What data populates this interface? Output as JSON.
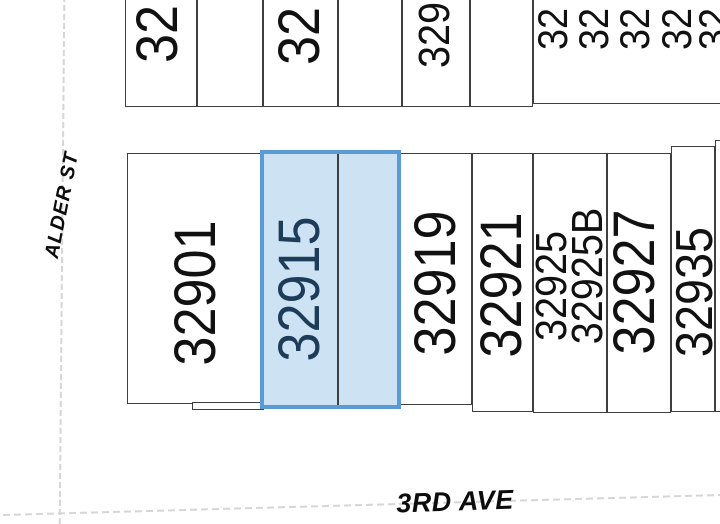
{
  "map": {
    "streets": {
      "alder_st": "ALDER ST",
      "third_ave": "3RD AVE"
    },
    "top_row_lots": [
      {
        "label": "32"
      },
      {
        "label": ""
      },
      {
        "label": "32"
      },
      {
        "label": ""
      },
      {
        "label": "329"
      },
      {
        "label": ""
      }
    ],
    "top_right_lot_labels": [
      "32",
      "32",
      "32",
      "32",
      "32"
    ],
    "bottom_row_lots": [
      {
        "label": "32901",
        "highlighted": false
      },
      {
        "label": "32915",
        "highlighted": true
      },
      {
        "label": "",
        "highlighted": true
      },
      {
        "label": "32919",
        "highlighted": false
      },
      {
        "label": "32921",
        "highlighted": false
      },
      {
        "label": "32925",
        "label2": "32925B",
        "highlighted": false
      },
      {
        "label": "32927",
        "highlighted": false
      },
      {
        "label": "32935",
        "highlighted": false
      }
    ],
    "colors": {
      "highlight_fill": "#cde3f3",
      "highlight_border": "#5b9bd5",
      "highlight_text": "#1d3c5a",
      "lot_line": "#3f3f3f",
      "street_line": "#d6d6d6",
      "label_text": "#111111"
    }
  }
}
